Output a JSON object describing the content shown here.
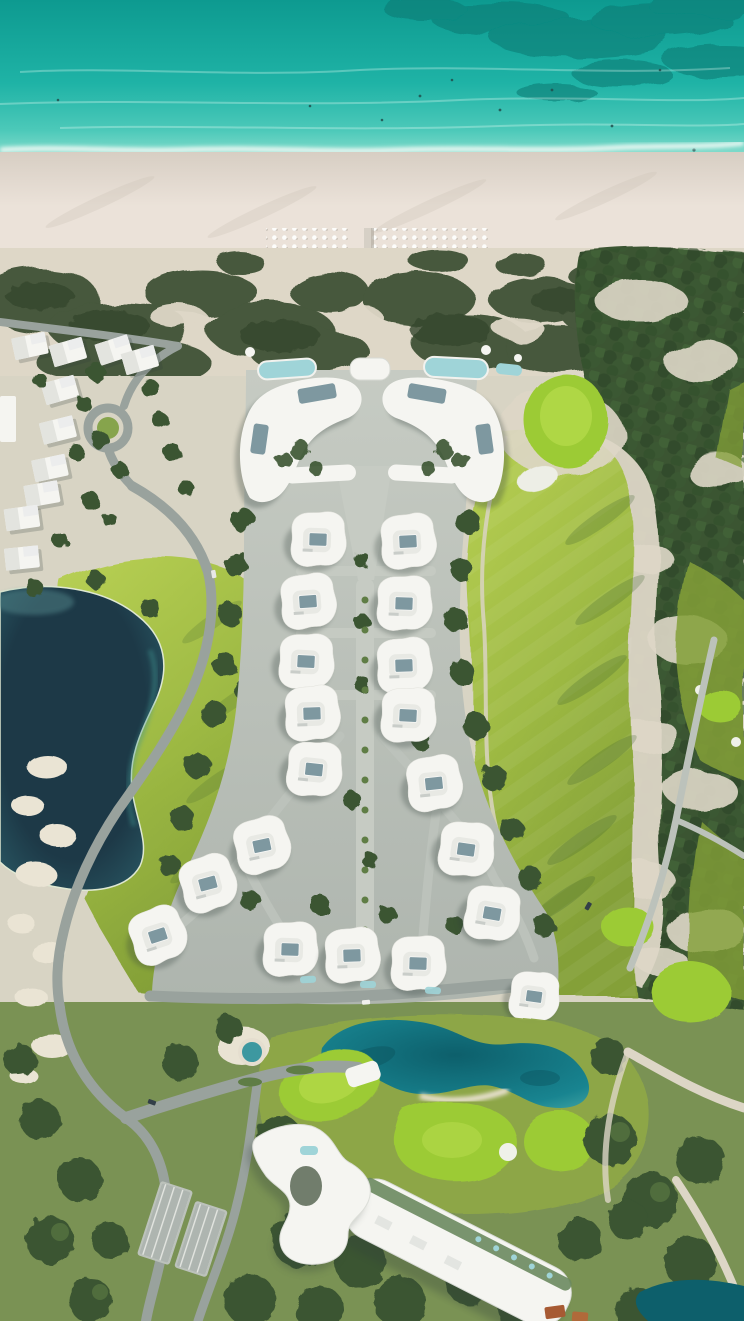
{
  "meta": {
    "title": "Beachfront resort masterplan — aerial view",
    "domain": "natural-image",
    "image_size": "744x1321"
  },
  "palette": {
    "ocean_deep": "#0d9a90",
    "ocean_mid": "#1fb3a6",
    "ocean_light": "#4cc9b9",
    "ocean_shallow": "#8edfcf",
    "shore_wash": "#cdeee2",
    "ocean_reef": "#077c75",
    "foam": "#f6fbf7",
    "sand_wet": "#d7cec3",
    "sand_dry": "#ebe2d9",
    "sand_dune": "#ded7c7",
    "scrub": "#46583c",
    "scrub_dark": "#36462d",
    "forest": "#3a5431",
    "forest_light": "#5f7d45",
    "parkland": "#7a9254",
    "fairway_light": "#b8d054",
    "fairway": "#9db943",
    "fairway_shade": "#84a038",
    "green_putting": "#9ccb35",
    "green_ring": "#bfe152",
    "lake_dark": "#1d3947",
    "lake_edge": "#2c5f6a",
    "lagoon": "#188490",
    "lagoon_deep": "#0d5f6b",
    "lagoon_edge": "#3fa3a2",
    "pool": "#9fd4d8",
    "road": "#99a29d",
    "road_light": "#bcc2bb",
    "hardscape": "#aeb5ae",
    "hardscape_light": "#c6cbc3",
    "building": "#f5f5f1",
    "building_inner": "#e8e9e4",
    "roof_pool": "#7e98a0",
    "shadow": "#31413a",
    "roof_red": "#a75a33",
    "car_dark": "#333f48"
  },
  "scene": {
    "ocean": {
      "description": "turquoise sea across the top",
      "features": [
        "dark reef patches at top right",
        "white surf line",
        "small swimmers"
      ]
    },
    "beach": {
      "description": "wide pale sand beach",
      "umbrella_clusters": 2,
      "scattered_umbrellas": true,
      "boardwalk_to_beach": true
    },
    "dunes": {
      "description": "band of dark green coastal scrub on sand"
    },
    "resort": {
      "crescent_beach_buildings": 2,
      "beach_club_pools": 3,
      "villas_with_roof_pools": 19,
      "central_spine": true,
      "ground_pools": 3
    },
    "golf_course": {
      "putting_greens": 9,
      "main_fairways": 3,
      "sand_bunkers": "multiple",
      "cart_paths": true,
      "sandy_waste_areas": true
    },
    "lakes": {
      "dark_lake_left": 1,
      "lagoon_center_bottom": 1,
      "round_pond": 1,
      "corner_pond_bottom_right": 1
    },
    "hotel": {
      "curved_west_wing": 1,
      "long_diagonal_slab": 1,
      "arrival_canopy": 1
    },
    "neighborhood": {
      "existing_terraced_villas": 11,
      "roundabout": true
    },
    "roads": {
      "winding_access_roads": true,
      "parking_lots": 2,
      "cars": 4
    }
  }
}
